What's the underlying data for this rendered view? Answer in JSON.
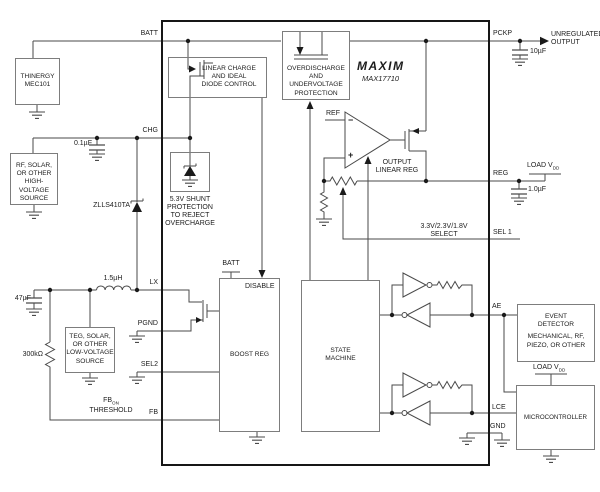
{
  "chip": {
    "brand": "MAXIM",
    "part": "MAX17710"
  },
  "pins": {
    "batt": "BATT",
    "chg": "CHG",
    "lx": "LX",
    "pgnd": "PGND",
    "sel2": "SEL2",
    "fb": "FB",
    "pckp": "PCKP",
    "reg": "REG",
    "sel1": "SEL 1",
    "ae": "AE",
    "lce": "LCE",
    "gnd": "GND"
  },
  "blocks": {
    "thinergy": {
      "l1": "THINERGY",
      "l2": "MEC101"
    },
    "hv_source": {
      "l1": "RF, SOLAR,",
      "l2": "OR OTHER",
      "l3": "HIGH-VOLTAGE",
      "l4": "SOURCE"
    },
    "lv_source": {
      "l1": "TEG, SOLAR,",
      "l2": "OR OTHER",
      "l3": "LOW-VOLTAGE",
      "l4": "SOURCE"
    },
    "linear_charge": {
      "l1": "LINEAR CHARGE",
      "l2": "AND IDEAL",
      "l3": "DIODE CONTROL"
    },
    "overdischarge": {
      "l1": "OVERDISCHARGE",
      "l2": "AND UNDERVOLTAGE",
      "l3": "PROTECTION"
    },
    "shunt": {
      "l1": "5.3V SHUNT",
      "l2": "PROTECTION",
      "l3": "TO REJECT",
      "l4": "OVERCHARGE"
    },
    "boost": {
      "title": "BOOST REG",
      "disable": "DISABLE",
      "batt_stub": "BATT"
    },
    "state": {
      "l1": "STATE",
      "l2": "MACHINE"
    },
    "linreg": {
      "l1": "OUTPUT",
      "l2": "LINEAR REG"
    },
    "event": {
      "l1": "EVENT",
      "l2": "DETECTOR",
      "l3": "MECHANICAL, RF,",
      "l4": "PIEZO, OR OTHER"
    },
    "micro": {
      "title": "MICROCONTROLLER"
    }
  },
  "components": {
    "c_chg": "0.1µF",
    "c_lx": "47µF",
    "c_pckp": "10µF",
    "c_reg": "1.0µF",
    "r_fb": "300kΩ",
    "l_boost": "1.5µH",
    "d_schottky": "ZLLS410TA"
  },
  "annotations": {
    "unreg1": "UNREGULATED",
    "unreg2": "OUTPUT",
    "sel_volt": "3.3V/2.3V/1.8V",
    "sel_word": "SELECT",
    "fb_base": "FB",
    "fb_sub": "ON",
    "threshold": "THRESHOLD",
    "loadv_base": "LOAD V",
    "loadv_sub": "DD",
    "ref": "REF",
    "minus": "−",
    "plus": "+"
  }
}
